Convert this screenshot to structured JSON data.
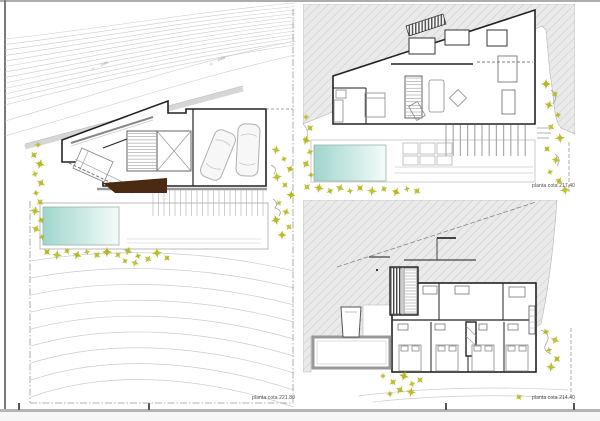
{
  "sheet": {
    "title": "architectural plans drawing sheet",
    "plans": [
      {
        "id": "site-plan",
        "caption": "planta cota 221.80"
      },
      {
        "id": "upper-floor-plan",
        "caption": "planta cota 217.40"
      },
      {
        "id": "bedroom-floor-plan",
        "caption": "planta cota 214.40"
      }
    ],
    "contour_labels": [
      "pobl.",
      "pobl."
    ]
  },
  "colors": {
    "wall": "#222222",
    "contour": "#cccccc",
    "tree": "#b5b41a",
    "pool_teal": "#9fd6cc",
    "pool_fade": "#f4fbf9",
    "slope_fill": "#eaeaea",
    "hatch_line": "#c9c9c9",
    "ramp_brown": "#4a2a12",
    "boundary": "#999999",
    "sheet_edge": "#b0b0b0"
  }
}
